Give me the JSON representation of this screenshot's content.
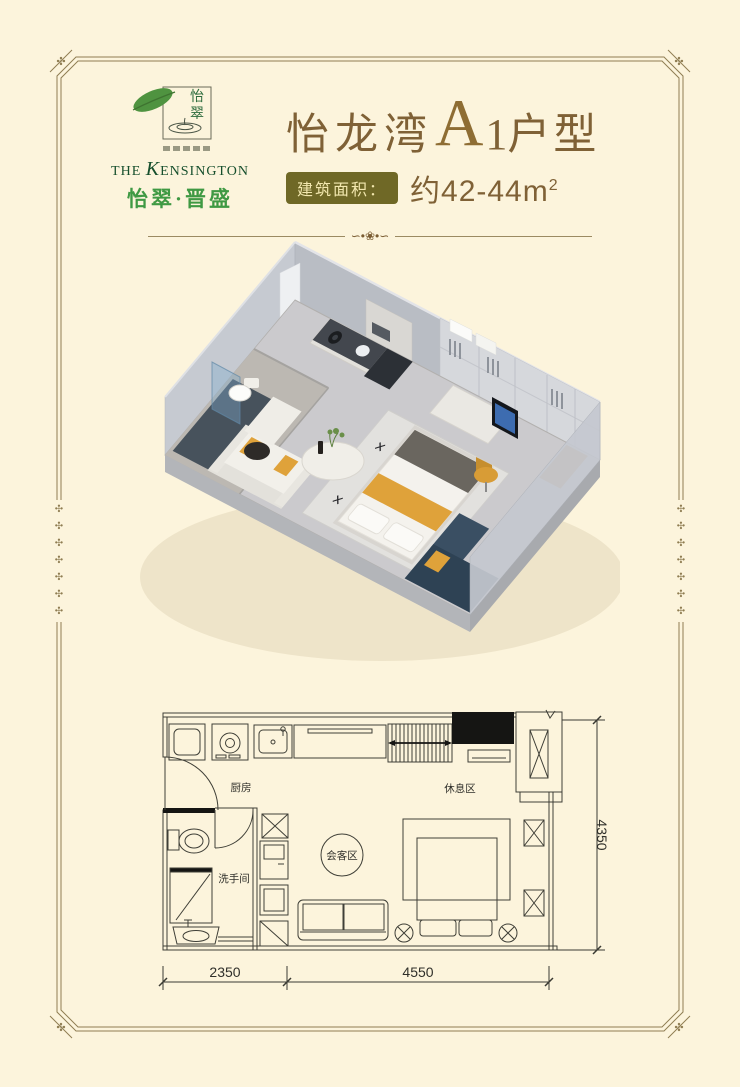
{
  "page": {
    "bg": "#fcf4dc",
    "frame_color": "#8f7d52"
  },
  "logo": {
    "seal_top": "怡",
    "seal_bottom": "翠",
    "en_the": "THE",
    "en_initial": "K",
    "en_rest": "ENSINGTON",
    "cn": "怡翠·晋盛"
  },
  "title": {
    "project": "怡龙湾",
    "unit_letter": "A",
    "unit_number": "1",
    "unit_suffix": "户型",
    "badge": "建筑面积：",
    "area": "约42-44m",
    "area_sup": "2"
  },
  "floorplan": {
    "labels": {
      "kitchen": "厨房",
      "bath": "洗手间",
      "living": "会客区",
      "rest": "休息区"
    },
    "dims": {
      "bottom_left": "2350",
      "bottom_right": "4550",
      "right": "4350"
    }
  },
  "icons": {
    "corner_flower": "✣",
    "edge_cross": "✣",
    "divider_ornament": "∽•❀•∽",
    "rug_pattern": "✕ ✕ ✕ ✕"
  },
  "colors": {
    "title_brown": "#7f6136",
    "badge_bg": "#6f6826",
    "brand_green": "#3f9943",
    "accent_yellow": "#dfa23a"
  }
}
